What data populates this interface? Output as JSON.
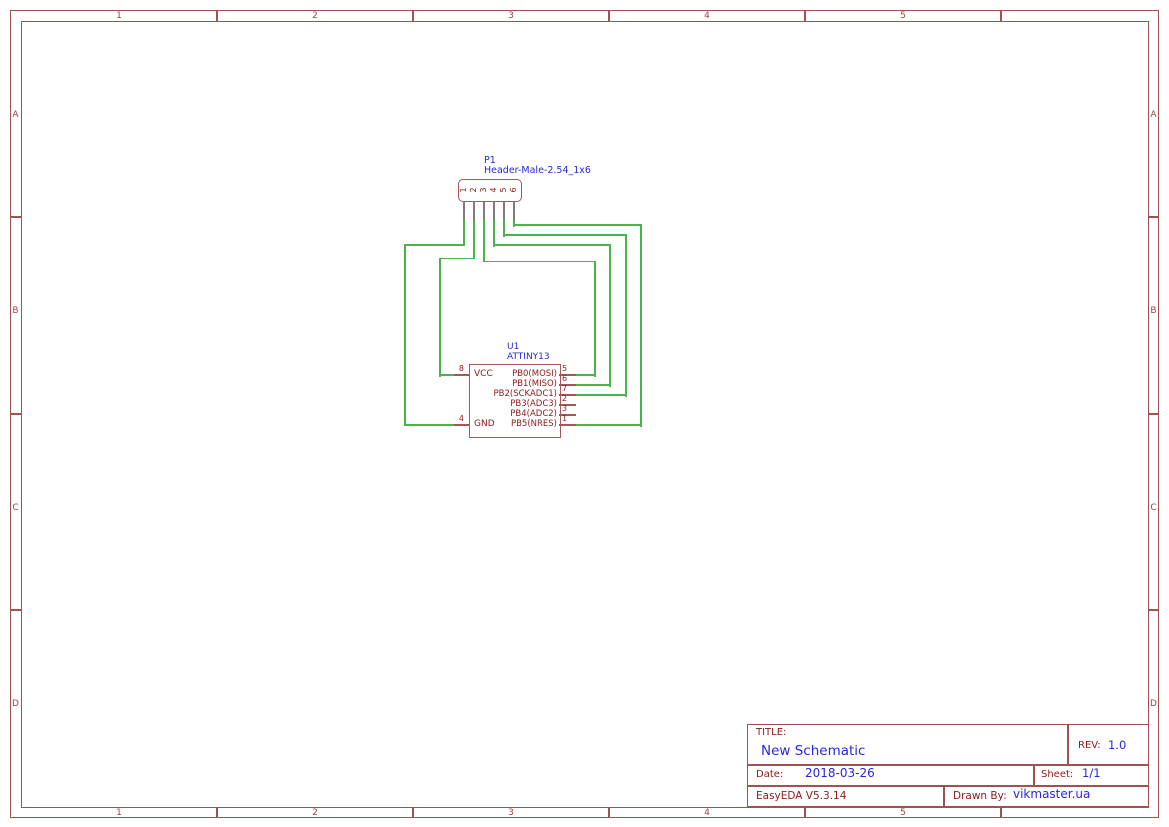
{
  "colors": {
    "frame": "#a05252",
    "frame-text": "#9a4444",
    "component": "#a65858",
    "schematic-text": "#8b1a1a",
    "value-text": "#2828d8",
    "wire": "#4cb24c",
    "pin-stub": "#7d7d7d",
    "background": "#ffffff"
  },
  "frame": {
    "column_labels": [
      "1",
      "2",
      "3",
      "4",
      "5"
    ],
    "row_labels": [
      "A",
      "B",
      "C",
      "D"
    ]
  },
  "schematic": {
    "p1": {
      "reference": "P1",
      "value": "Header-Male-2.54_1x6",
      "pin_numbers": [
        "1",
        "2",
        "3",
        "4",
        "5",
        "6"
      ]
    },
    "u1": {
      "reference": "U1",
      "value": "ATTINY13",
      "left_pins": [
        {
          "number": "8",
          "name": "VCC"
        },
        {
          "number": "4",
          "name": "GND"
        }
      ],
      "right_pins": [
        {
          "number": "5",
          "name": "PB0(MOSI)"
        },
        {
          "number": "6",
          "name": "PB1(MISO)"
        },
        {
          "number": "7",
          "name": "PB2(SCKADC1)"
        },
        {
          "number": "2",
          "name": "PB3(ADC3)"
        },
        {
          "number": "3",
          "name": "PB4(ADC2)"
        },
        {
          "number": "1",
          "name": "PB5(NRES)"
        }
      ]
    }
  },
  "title_block": {
    "title_label": "TITLE:",
    "title": "New Schematic",
    "rev_label": "REV:",
    "rev": "1.0",
    "date_label": "Date:",
    "date": "2018-03-26",
    "sheet_label": "Sheet:",
    "sheet": "1/1",
    "version": "EasyEDA V5.3.14",
    "drawn_by_label": "Drawn By:",
    "drawn_by": "vikmaster.ua"
  }
}
